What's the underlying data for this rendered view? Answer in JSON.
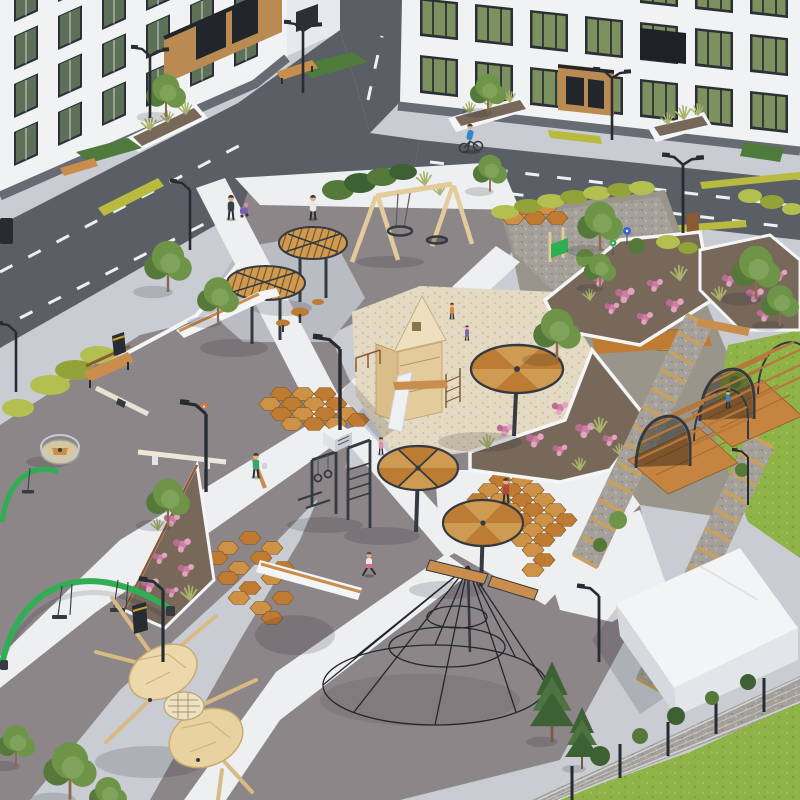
{
  "scene": {
    "type": "3d-architectural-render",
    "view": "aerial-isometric courtyard view",
    "subject": "Residential courtyard playground and landscaping design render",
    "buildings": [
      "L-shaped white apartment block (left)",
      "white apartment block with shop fronts (top-right)",
      "small white utility building (bottom-right)"
    ],
    "circulation": [
      "asphalt access road with dashed lane markings",
      "white concrete walkways crossing the plaza",
      "hexagonal terracotta paving accents",
      "sleeper-and-gravel garden paths",
      "arched timber pergola walkway"
    ],
    "play_equipment": [
      "round timber shade canopies on single posts",
      "timber lattice table-canopies with stools",
      "wooden A-frame swing with nest swing",
      "sand pit with wooden play tower and slide",
      "workout station with gymnastic rings",
      "carousel spinner",
      "seesaw balance beams",
      "green arched swing sets",
      "climbing rope pyramid",
      "carved wooden play sculpture",
      "kids gravel corner with pinwheel toys and climbing frame"
    ],
    "landscape": [
      "perennial flower beds with pink blooms",
      "ornamental grass planters",
      "yellow-green hedges along the road",
      "street trees and pines",
      "lawns",
      "mesh perimeter fence"
    ],
    "street_furniture": [
      "street lamps",
      "wooden benches",
      "white seat walls",
      "litter bins"
    ],
    "people": [
      "cyclist on road",
      "parent with stroller",
      "walking adults",
      "running child",
      "toddler",
      "children in sand pit",
      "person under pergola"
    ],
    "wildlife": [
      "small orange bird perched on lamp"
    ]
  },
  "palette": {
    "sidewalk": "#c9cdd3",
    "road": "#5a5f66",
    "road_mark": "#eef0f3",
    "yellow_strip": "#b9ba40",
    "plaza": "#8d8689",
    "concrete": "#b9bcc2",
    "path": "#edeff1",
    "sand": "#e4d9c2",
    "sand_dot": "#cfc0a0",
    "gravel": "#a5a19a",
    "gravel_dot": "#8d8780",
    "garden": "#99958a",
    "hex_a": "#c07b32",
    "hex_b": "#ce9247",
    "hex_stroke": "#8a5a22",
    "grass": "#8fb347",
    "turf": "#4e7a3c",
    "hedge": "#b3bf4e",
    "hedge_dark": "#93a339",
    "foliage1": "#6d9447",
    "foliage2": "#55793a",
    "pine": "#3e6134",
    "soil": "#77685a",
    "flower1": "#cc7fa4",
    "flower2": "#e3a3c0",
    "wood": "#c98d4d",
    "wood_light": "#e3cb9c",
    "wood_dark": "#8a5a33",
    "canopy_a": "#cf9a52",
    "canopy_b": "#bd7c33",
    "frame": "#343a40",
    "white": "#f4f5f7",
    "building": "#f1f2f4",
    "building_shade": "#e6e9ed",
    "plinth": "#676c74",
    "window_frame": "#2c3036",
    "glass": "#5d7058",
    "portal": "#b98b52",
    "door": "#22262b",
    "fence": "#cfd4da",
    "lamp": "#272c32",
    "skin": "#e5b08c",
    "equip_green": "#2fae54",
    "accent_blue": "#2f86c8",
    "accent_red": "#b0483c",
    "accent_purple": "#7a5fb0",
    "accent_pink": "#e08bb0",
    "accent_orange": "#d9883b",
    "accent_teal": "#3aa86c"
  }
}
